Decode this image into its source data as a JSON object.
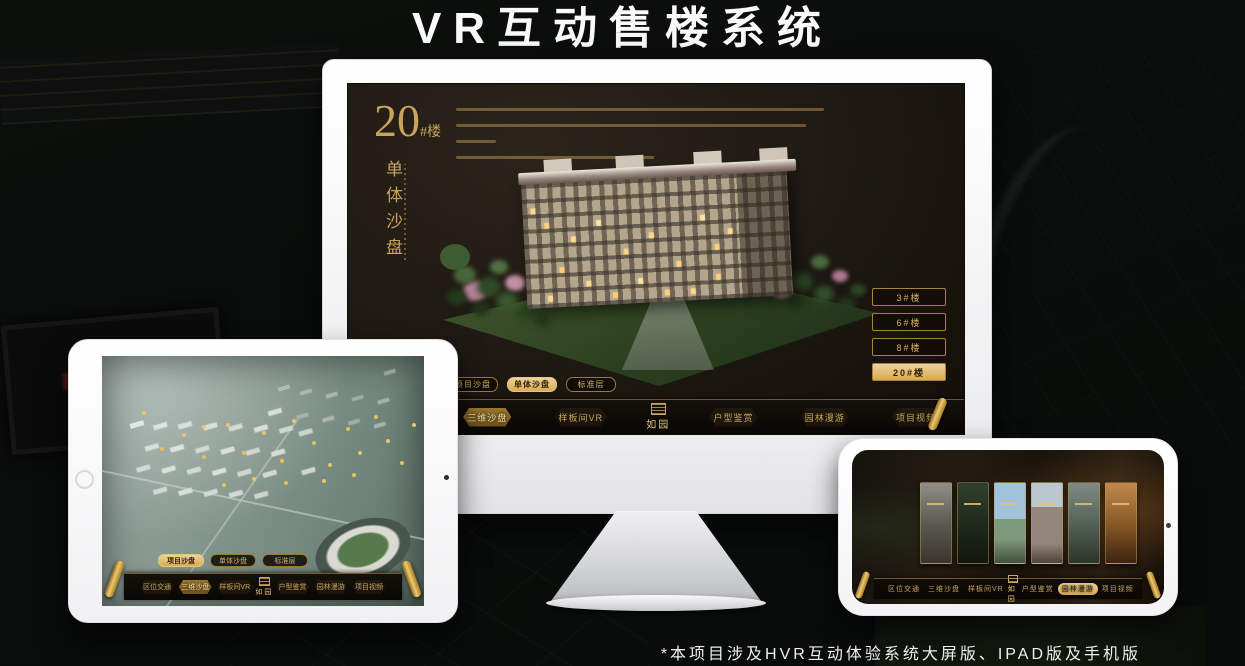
{
  "page": {
    "title": "VR互动售楼系统",
    "footnote": "*本项目涉及HVR互动体验系统大屏版、IPAD版及手机版"
  },
  "colors": {
    "gold": "#c9a45c",
    "gold_active_bg": "#d9a94f",
    "screen_dark": "#1d1812"
  },
  "monitor": {
    "heading": {
      "number": "20",
      "suffix": "#楼",
      "subtitle_vertical": "单体沙盘"
    },
    "floor_buttons": [
      {
        "label": "3#楼",
        "active": false
      },
      {
        "label": "6#楼",
        "active": false
      },
      {
        "label": "8#楼",
        "active": false
      },
      {
        "label": "20#楼",
        "active": true
      }
    ],
    "sub_tabs": [
      {
        "label": "项目沙盘",
        "active": false
      },
      {
        "label": "单体沙盘",
        "active": true
      },
      {
        "label": "标准层",
        "active": false
      }
    ],
    "nav_items": [
      {
        "label": "区位交通",
        "active": false
      },
      {
        "label": "三维沙盘",
        "active": true
      },
      {
        "label": "样板间VR",
        "active": false
      },
      {
        "label": "户型鉴赏",
        "active": false
      },
      {
        "label": "园林漫游",
        "active": false
      },
      {
        "label": "项目视频",
        "active": false
      }
    ],
    "logo": "如园"
  },
  "tablet": {
    "sub_tabs": [
      {
        "label": "项目沙盘",
        "active": true
      },
      {
        "label": "单体沙盘",
        "active": false
      },
      {
        "label": "标准层",
        "active": false
      }
    ],
    "nav_items": [
      {
        "label": "区位交通",
        "active": false
      },
      {
        "label": "三维沙盘",
        "active": true
      },
      {
        "label": "样板间VR",
        "active": false
      },
      {
        "label": "户型鉴赏",
        "active": false
      },
      {
        "label": "园林漫游",
        "active": false
      },
      {
        "label": "项目视频",
        "active": false
      }
    ],
    "logo": "如园"
  },
  "phone": {
    "nav_items": [
      {
        "label": "区位交通",
        "active": false
      },
      {
        "label": "三维沙盘",
        "active": false
      },
      {
        "label": "样板间VR",
        "active": false
      },
      {
        "label": "户型鉴赏",
        "active": false
      },
      {
        "label": "园林漫游",
        "active": true
      },
      {
        "label": "项目视频",
        "active": false
      }
    ],
    "logo": "如园"
  }
}
